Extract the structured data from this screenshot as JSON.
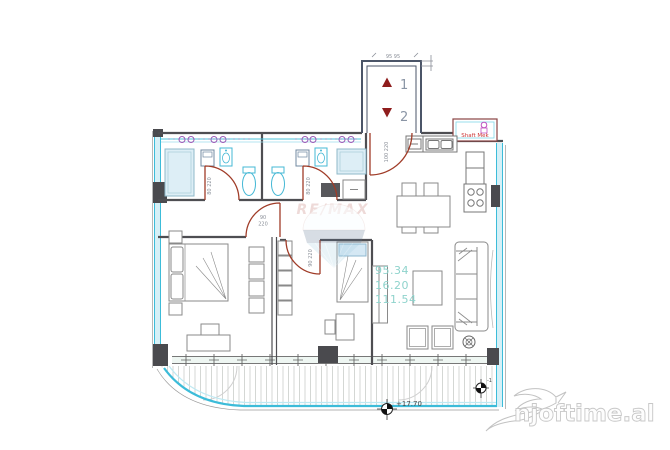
{
  "watermark": {
    "brand_center": "RE/MAX",
    "brand_corner": "njoftime.al"
  },
  "stairwell": {
    "up_number": "1",
    "down_number": "2",
    "top_dimension": "95 95"
  },
  "labels": {
    "shaft": "Shaft Mek",
    "door_bath1": "80 220",
    "door_bath2": "80 220",
    "door_bedroom1_width": "90",
    "door_bedroom1_height": "220",
    "door_bedroom2": "90 220",
    "door_entry": "100 220"
  },
  "areas": {
    "net": "95.34",
    "balcony": "16.20",
    "total": "111.54"
  },
  "elevation": {
    "balcony_level": "+17.70",
    "corner_mark": "-1"
  },
  "colors": {
    "wall": "#4e4e52",
    "glazing": "#3cbcd9",
    "glazing_fill": "#d6f0f7",
    "door_arc": "#a03c28",
    "stair_arrow": "#8f1d1d",
    "area_text": "#8fd3cc",
    "plumbing_line": "#4cc3da",
    "plumbing_valve": "#9b59b6",
    "shaft_text": "#cc3333",
    "watermark_band": "#5d7590"
  }
}
